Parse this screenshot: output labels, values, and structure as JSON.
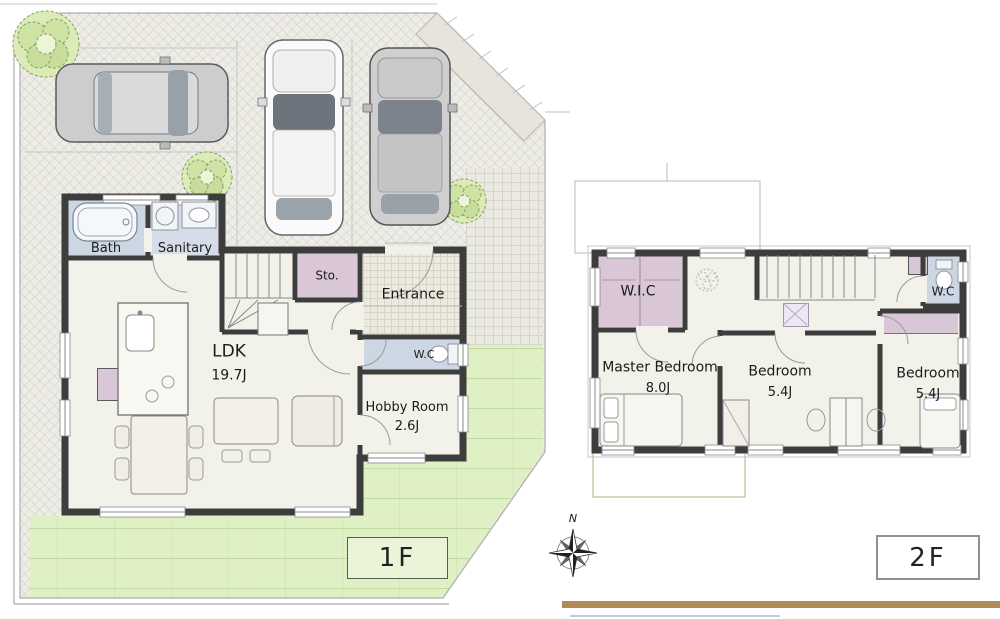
{
  "floor1": {
    "tag": "1F",
    "rooms": {
      "bath": {
        "label": "Bath"
      },
      "sanitary": {
        "label": "Sanitary"
      },
      "storage": {
        "label": "Sto."
      },
      "entrance": {
        "label": "Entrance"
      },
      "wc": {
        "label": "W.C"
      },
      "ldk": {
        "label": "LDK",
        "size": "19.7J"
      },
      "hobby": {
        "label": "Hobby Room",
        "size": "2.6J"
      }
    }
  },
  "floor2": {
    "tag": "2F",
    "rooms": {
      "wic": {
        "label": "W.I.C"
      },
      "master_bedroom": {
        "label": "Master Bedroom",
        "size": "8.0J"
      },
      "bedroom_center": {
        "label": "Bedroom",
        "size": "5.4J"
      },
      "bedroom_right": {
        "label": "Bedroom",
        "size": "5.4J"
      },
      "wc": {
        "label": "W.C"
      }
    }
  },
  "compass": {
    "north_label": "N"
  },
  "colors": {
    "wall": "#3d3d3d",
    "floor": "#f3f2ea",
    "lawn": "#dff0c4",
    "closet_fill": "#d9c7d7",
    "wet_area_fill": "#cdd7e3",
    "accent_bar": "#b08a55"
  }
}
